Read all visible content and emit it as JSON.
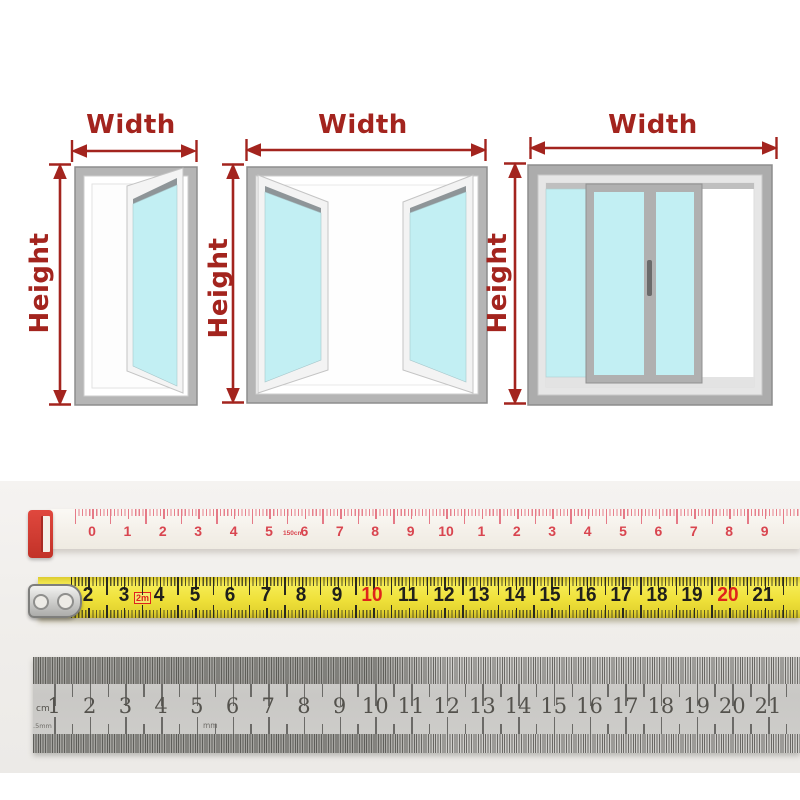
{
  "colors": {
    "accent": "#A3241E",
    "glass": "#C2EFF3",
    "window_frame": "#B5B5B5",
    "soft_tape_tick": "#E57A87",
    "soft_tape_number": "#D9454F",
    "tape_end_clip": "#D43A30",
    "yellow_tape": "#EFE13A",
    "yellow_tape_number": "#20201C",
    "yellow_tape_red": "#DF241B",
    "steel_ruler": "#CDCCC9",
    "steel_ruler_number": "#54524D"
  },
  "guide": {
    "width_label": "Width",
    "height_label": "Height",
    "windows": [
      "single-casement-window",
      "double-casement-window",
      "sliding-window"
    ]
  },
  "soft_tape": {
    "numbers": [
      "0",
      "1",
      "2",
      "3",
      "4",
      "5",
      "6",
      "7",
      "8",
      "9",
      "10",
      "1",
      "2",
      "3",
      "4",
      "5",
      "6",
      "7",
      "8",
      "9"
    ],
    "length_label": "150cm"
  },
  "yellow_tape": {
    "numbers": [
      "2",
      "3",
      "4",
      "5",
      "6",
      "7",
      "8",
      "9",
      "10",
      "11",
      "12",
      "13",
      "14",
      "15",
      "16",
      "17",
      "18",
      "19",
      "20",
      "21"
    ],
    "red_numbers": [
      "10",
      "20"
    ],
    "capacity_label": "2m"
  },
  "steel_ruler": {
    "numbers": [
      "1",
      "2",
      "3",
      "4",
      "5",
      "6",
      "7",
      "8",
      "9",
      "10",
      "11",
      "12",
      "13",
      "14",
      "15",
      "16",
      "17",
      "18",
      "19",
      "20",
      "21"
    ],
    "unit_cm_label": "cm",
    "unit_mm_label": "mm",
    "unit_half_mm_label": ".5mm"
  }
}
